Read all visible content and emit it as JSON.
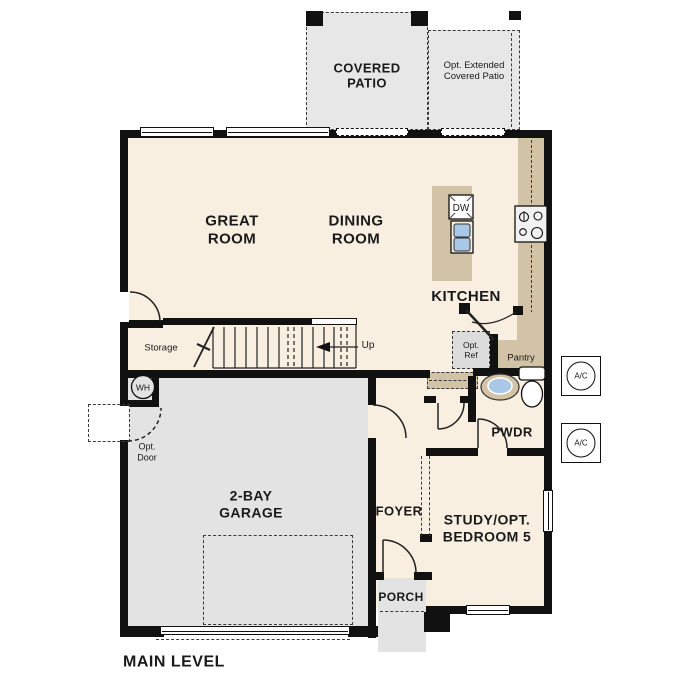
{
  "plan_title": "MAIN LEVEL",
  "colors": {
    "wall": "#111111",
    "floor": "#f8efe1",
    "garage": "#e3e3e3",
    "patio": "#e7e7e7",
    "counter": "#d3c3a6",
    "sink_blue": "#a9c7e6",
    "opt_ref_gray": "#dcdcdc"
  },
  "patio": {
    "covered": [
      "COVERED",
      "PATIO"
    ],
    "extended": [
      "Opt. Extended",
      "Covered Patio"
    ]
  },
  "rooms": {
    "great_room": [
      "GREAT",
      "ROOM"
    ],
    "dining_room": [
      "DINING",
      "ROOM"
    ],
    "kitchen": "KITCHEN",
    "garage": [
      "2-BAY",
      "GARAGE"
    ],
    "study": [
      "STUDY/OPT.",
      "BEDROOM 5"
    ],
    "foyer": "FOYER",
    "porch": "PORCH",
    "pwdr": "PWDR",
    "pantry": "Pantry",
    "storage": "Storage"
  },
  "fixtures": {
    "up": "Up",
    "dw": "DW",
    "wh": "WH",
    "ac": "A/C",
    "opt_ref": [
      "Opt.",
      "Ref"
    ],
    "opt_door": [
      "Opt.",
      "Door"
    ]
  }
}
